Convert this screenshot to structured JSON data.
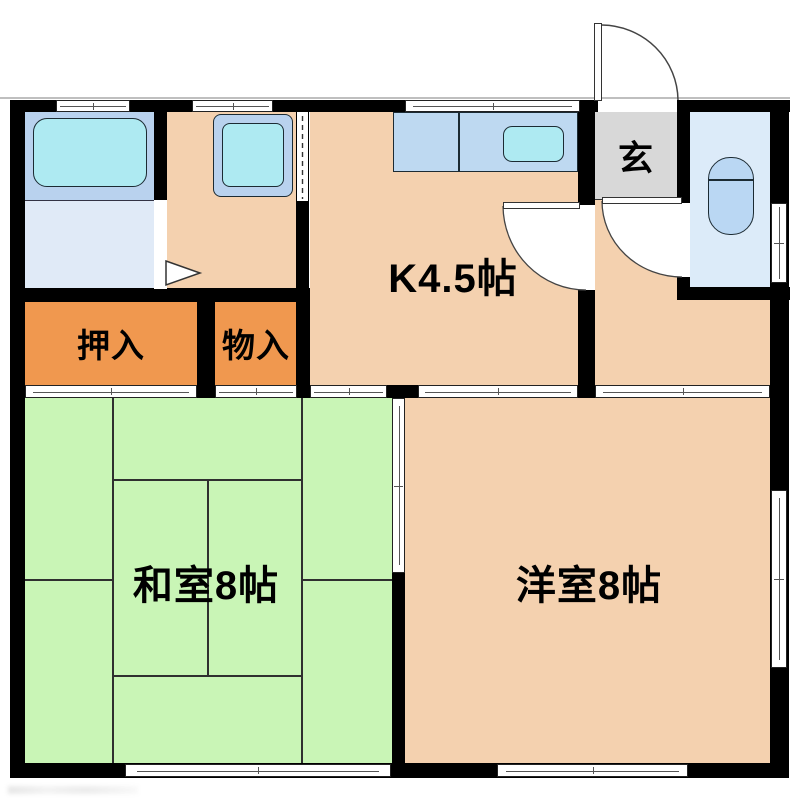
{
  "title": "2K apartment floor plan",
  "rooms": {
    "kitchen": {
      "label": "K4.5帖"
    },
    "genkan": {
      "label": "玄"
    },
    "oshiire": {
      "label": "押入"
    },
    "monoire": {
      "label": "物入"
    },
    "washitsu": {
      "label": "和室8帖"
    },
    "youshitsu": {
      "label": "洋室8帖"
    }
  },
  "fixtures": {
    "bathtub": "bathtub",
    "washing_machine": "washing-machine",
    "kitchen_counter": "kitchen-counter",
    "kitchen_sink": "kitchen-sink",
    "toilet": "toilet",
    "entrance_door": "entrance-swing-door",
    "interior_doors": "swing-door",
    "sliding_doors": "sliding-door",
    "windows": "window"
  },
  "colors": {
    "wall": "#000000",
    "floor": "#f4d1af",
    "closet": "#f0984f",
    "tatami": "#c9f5b6",
    "bath": "#b9d2ee",
    "washroom": "#e0eaf7",
    "cyan": "#aeeaf2",
    "counter": "#bed9f1",
    "toiletroom": "#dcebf9",
    "toiletfix": "#bad7f3",
    "genkan": "#d8d8d8"
  }
}
